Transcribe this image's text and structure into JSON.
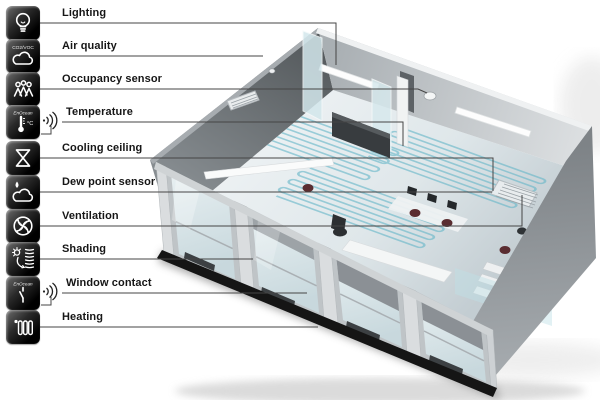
{
  "title": "Room automation functions diagram",
  "legend": {
    "items": [
      {
        "label": "Lighting",
        "icon": "lightbulb-icon"
      },
      {
        "label": "Air quality",
        "icon": "air-quality-cloud-icon",
        "icon_caption": "CO2/VOC"
      },
      {
        "label": "Occupancy sensor",
        "icon": "occupancy-people-icon"
      },
      {
        "label": "Temperature",
        "icon": "thermometer-icon",
        "icon_caption": "EnOcean",
        "icon_unit": "°C",
        "wireless": true
      },
      {
        "label": "Cooling ceiling",
        "icon": "cooling-valve-icon"
      },
      {
        "label": "Dew point sensor",
        "icon": "dew-point-cloud-icon"
      },
      {
        "label": "Ventilation",
        "icon": "fan-icon"
      },
      {
        "label": "Shading",
        "icon": "shading-blind-sun-icon"
      },
      {
        "label": "Window contact",
        "icon": "window-contact-switch-icon",
        "icon_caption": "EnOcean",
        "wireless": true
      },
      {
        "label": "Heating",
        "icon": "radiator-icon"
      }
    ]
  },
  "scene": {
    "type": "3d-cutaway-office-room",
    "elements": [
      "ceiling-light-fixtures",
      "occupancy-sensor-disc",
      "wall-vent-grille",
      "air-quality-sensor-dot",
      "glass-partitions",
      "capillary-cooling-mats",
      "floor-vent-grille",
      "desks-and-chairs",
      "window-facade-with-blinds",
      "radiators",
      "black-plinth"
    ],
    "colors": {
      "pipe_blue": "#68b7c8",
      "wall_dark": "#6a6f73",
      "wall_light": "#c9ced2",
      "glass": "#d9e8ec",
      "plinth": "#151515",
      "leader_line": "#454545",
      "legend_tile": "#000000",
      "label_text": "#161616"
    }
  }
}
